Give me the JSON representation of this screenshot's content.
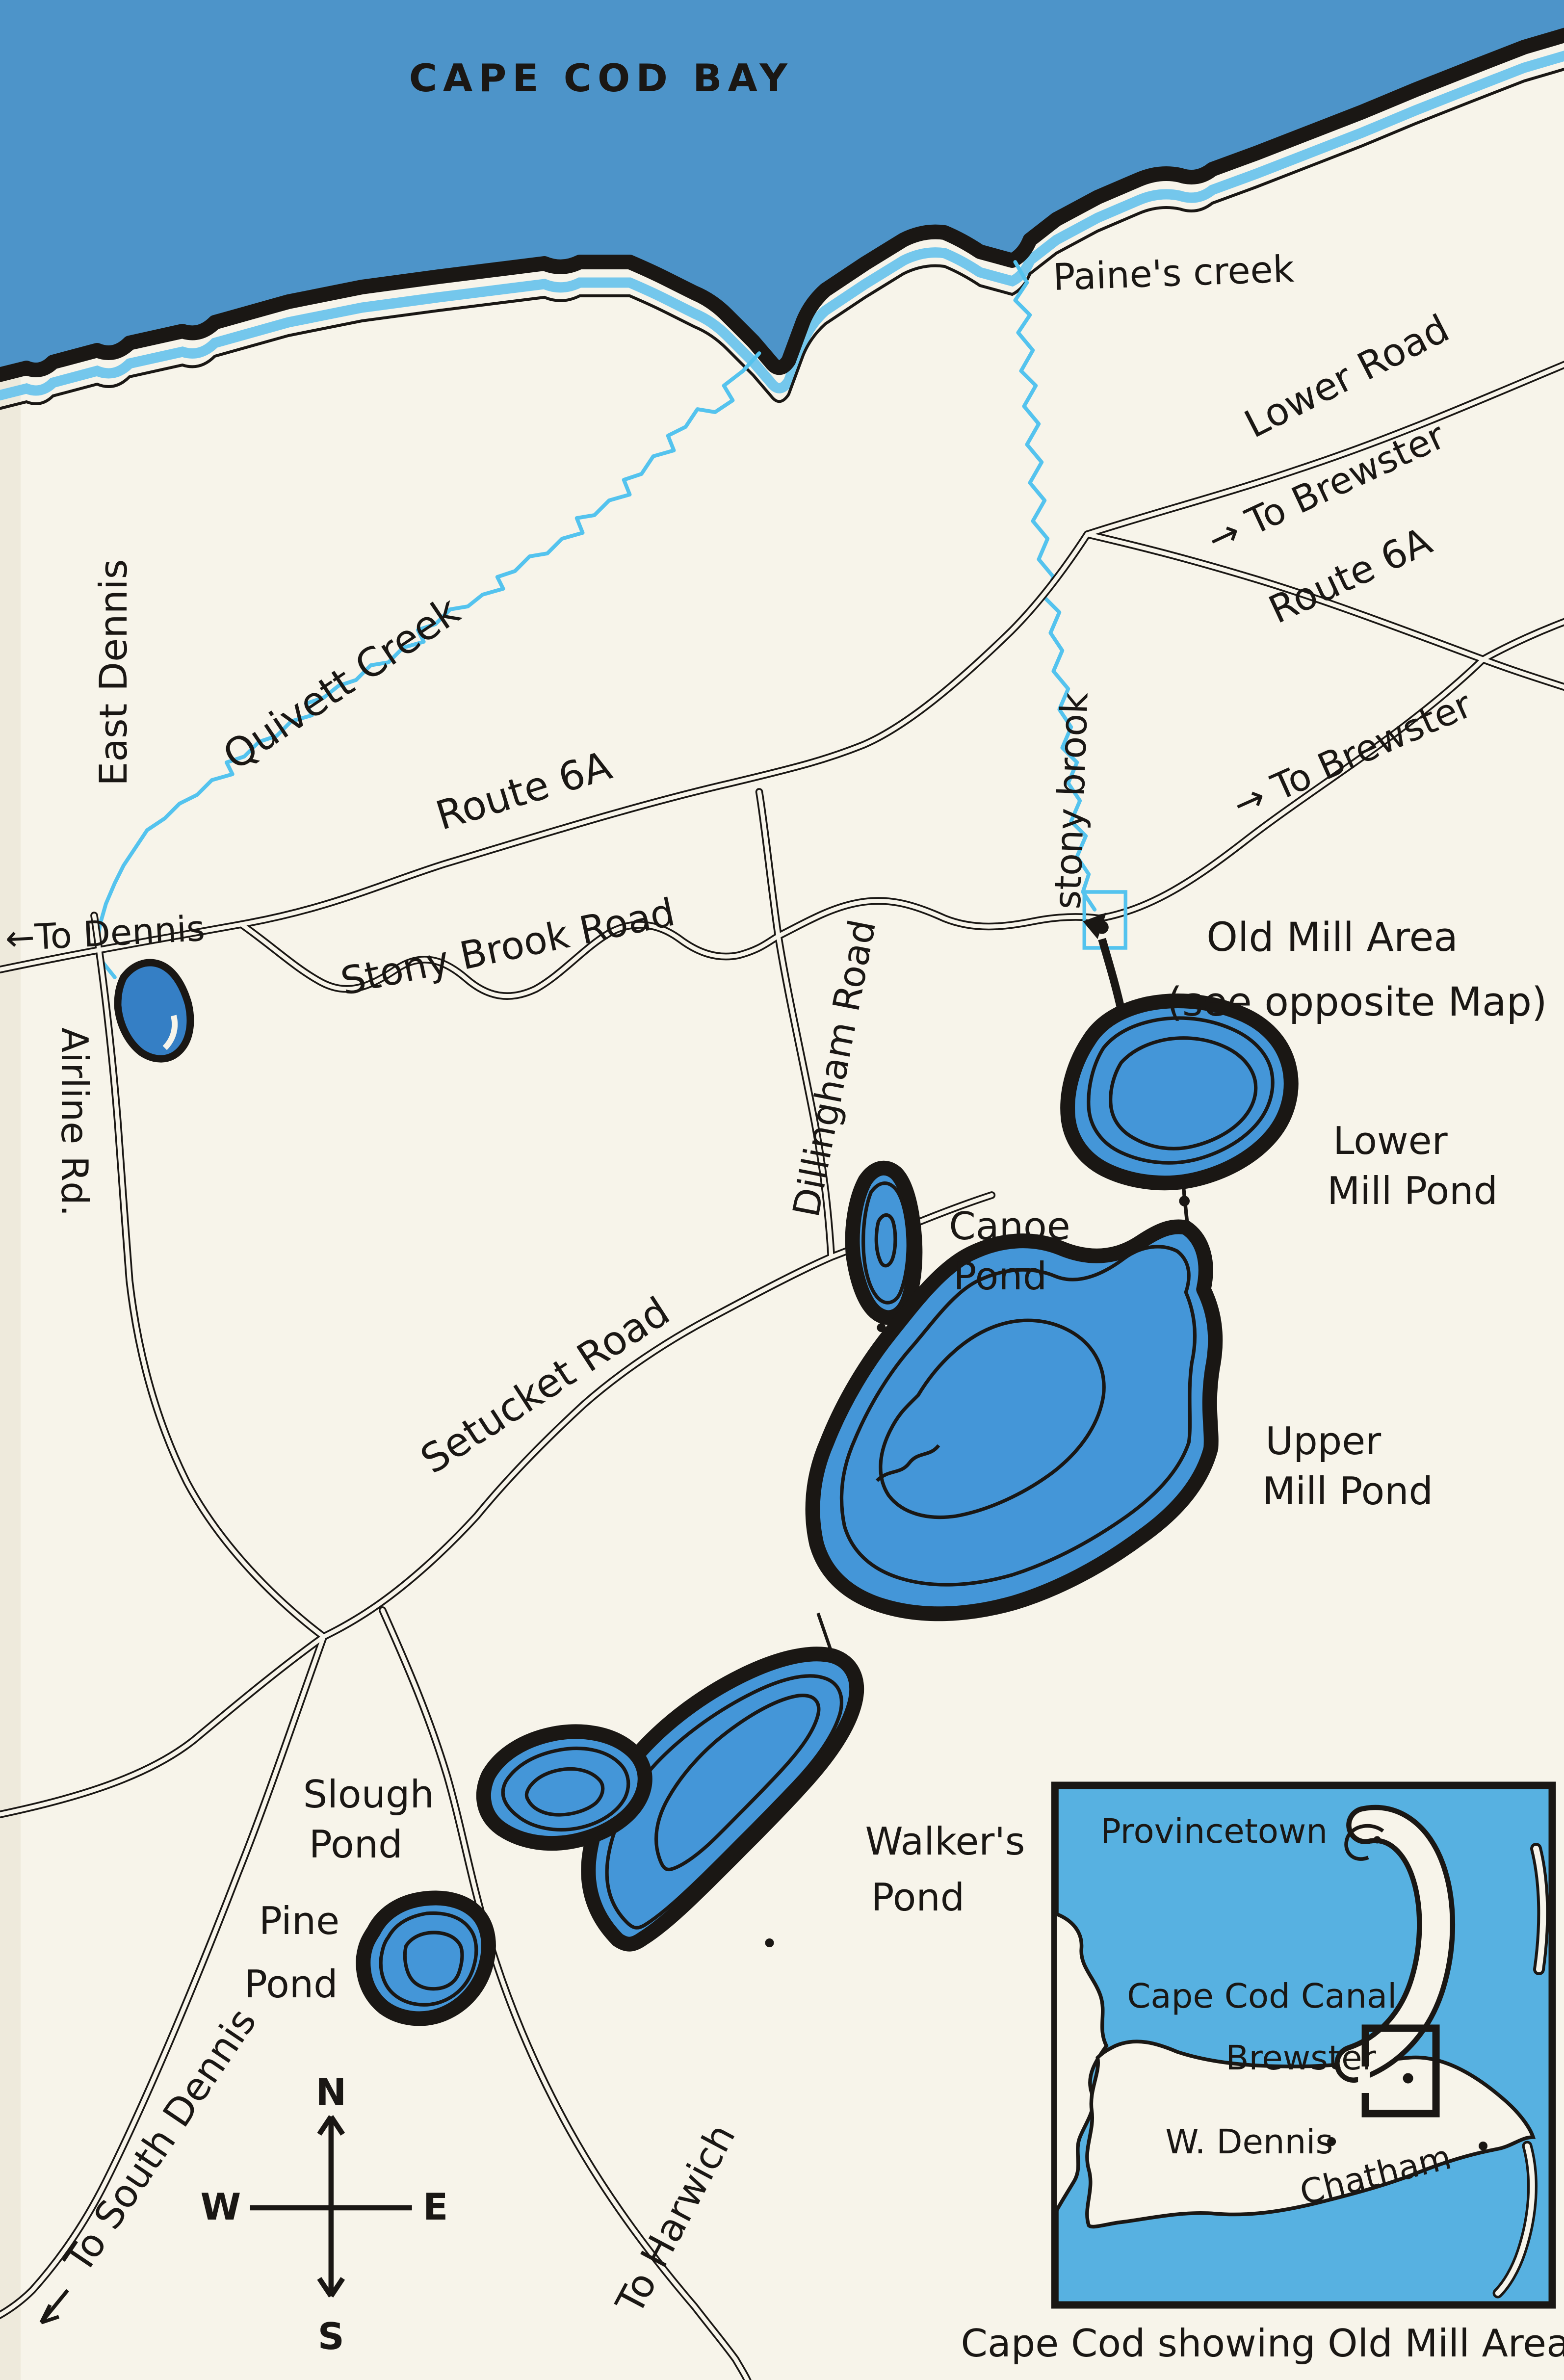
{
  "map": {
    "title": "CAPE COD BAY",
    "water_labels": {
      "paines_creek": "Paine's creek",
      "quivett_creek": "Quivett Creek",
      "stony_brook": "stony brook"
    },
    "road_labels": {
      "lower_road": "Lower Road",
      "to_brewster_upper": "→ To Brewster",
      "route_6a_east": "Route 6A",
      "to_brewster_mid": "→ To Brewster",
      "route_6a_west": "Route 6A",
      "to_dennis": "←To Dennis",
      "stony_brook_road": "Stony Brook Road",
      "dillingham_road": "Dillingham Road",
      "setucket_road": "Setucket Road",
      "airline_rd": "Airline Rd.",
      "to_south_dennis": "To South Dennis",
      "to_harwich": "To Harwich"
    },
    "place_labels": {
      "east_dennis": "East Dennis"
    },
    "poi": {
      "old_mill_line1": "Old Mill Area",
      "old_mill_line2": "(see opposite Map)"
    },
    "ponds": {
      "lower_mill_1": "Lower",
      "lower_mill_2": "Mill Pond",
      "canoe_1": "Canoe",
      "canoe_2": "Pond",
      "upper_mill_1": "Upper",
      "upper_mill_2": "Mill Pond",
      "slough_1": "Slough",
      "slough_2": "Pond",
      "pine_1": "Pine",
      "pine_2": "Pond",
      "walkers_1": "Walker's",
      "walkers_2": "Pond"
    },
    "compass": {
      "n": "N",
      "e": "E",
      "s": "S",
      "w": "W"
    },
    "inset": {
      "provincetown": "Provincetown",
      "cape_cod_canal": "Cape Cod Canal",
      "brewster": "Brewster",
      "w_dennis": "W. Dennis",
      "chatham": "Chatham",
      "caption": "Cape Cod showing Old Mill Area"
    },
    "colors": {
      "bay": "#4d94c9",
      "shallow": "#74c7ec",
      "creek": "#54c3ee",
      "pond": "#4496d8",
      "pond_dark": "#357fc5",
      "inset_water": "#57b1e1",
      "ink": "#1a1714",
      "paper": "#f7f4ea"
    }
  }
}
